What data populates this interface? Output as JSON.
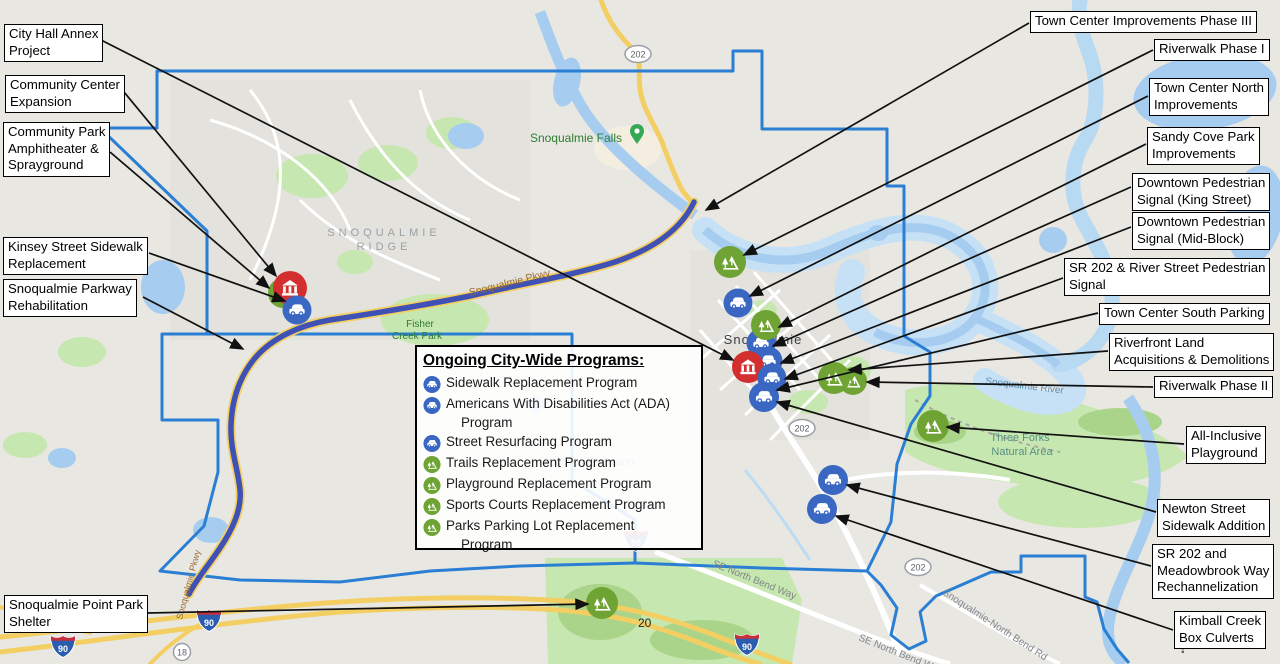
{
  "legend": {
    "title": "Ongoing City-Wide Programs:",
    "items": [
      {
        "icon": "car",
        "lines": [
          "Sidewalk Replacement Program"
        ]
      },
      {
        "icon": "car",
        "lines": [
          "Americans With Disabilities Act (ADA)",
          "Program"
        ]
      },
      {
        "icon": "car",
        "lines": [
          "Street Resurfacing Program"
        ]
      },
      {
        "icon": "park",
        "lines": [
          "Trails Replacement Program"
        ]
      },
      {
        "icon": "park",
        "lines": [
          "Playground Replacement Program"
        ]
      },
      {
        "icon": "park",
        "lines": [
          "Sports Courts Replacement Program"
        ]
      },
      {
        "icon": "park",
        "lines": [
          "Parks Parking Lot Replacement",
          "Program"
        ]
      }
    ]
  },
  "left_labels": [
    {
      "key": "city-hall-annex",
      "lines": [
        "City Hall Annex",
        "Project"
      ]
    },
    {
      "key": "community-center-expansion",
      "lines": [
        "Community Center",
        "Expansion"
      ]
    },
    {
      "key": "community-park-amphitheater",
      "lines": [
        "Community Park",
        "Amphitheater &",
        "Sprayground"
      ]
    },
    {
      "key": "kinsey-street-sidewalk",
      "lines": [
        "Kinsey Street Sidewalk",
        "Replacement"
      ]
    },
    {
      "key": "snoqualmie-parkway-rehab",
      "lines": [
        "Snoqualmie Parkway",
        "Rehabilitation"
      ]
    },
    {
      "key": "snoqualmie-point-park-shelter",
      "lines": [
        "Snoqualmie Point Park",
        "Shelter"
      ]
    }
  ],
  "right_labels": [
    {
      "key": "town-center-improvements-phase-3",
      "lines": [
        "Town Center Improvements Phase III"
      ]
    },
    {
      "key": "riverwalk-phase-1",
      "lines": [
        "Riverwalk Phase I"
      ]
    },
    {
      "key": "town-center-north-improvements",
      "lines": [
        "Town Center North",
        "Improvements"
      ]
    },
    {
      "key": "sandy-cove-park-improvements",
      "lines": [
        "Sandy Cove Park",
        "Improvements"
      ]
    },
    {
      "key": "downtown-pedestrian-signal-king-street",
      "lines": [
        "Downtown Pedestrian",
        "Signal (King Street)"
      ]
    },
    {
      "key": "downtown-pedestrian-signal-mid-block",
      "lines": [
        "Downtown Pedestrian",
        "Signal (Mid-Block)"
      ]
    },
    {
      "key": "sr202-river-street-pedestrian-signal",
      "lines": [
        "SR 202 & River Street Pedestrian",
        "Signal"
      ]
    },
    {
      "key": "town-center-south-parking",
      "lines": [
        "Town Center South Parking"
      ]
    },
    {
      "key": "riverfront-land-acquisitions",
      "lines": [
        "Riverfront Land",
        "Acquisitions & Demolitions"
      ]
    },
    {
      "key": "riverwalk-phase-2",
      "lines": [
        "Riverwalk Phase II"
      ]
    },
    {
      "key": "all-inclusive-playground",
      "lines": [
        "All-Inclusive",
        "Playground"
      ]
    },
    {
      "key": "newton-street-sidewalk-addition",
      "lines": [
        "Newton Street",
        "Sidewalk Addition"
      ]
    },
    {
      "key": "sr202-meadowbrook-way-rechannelization",
      "lines": [
        "SR 202 and",
        "Meadowbrook Way",
        "Rechannelization"
      ]
    },
    {
      "key": "kimball-creek-box-culverts",
      "lines": [
        "Kimball Creek",
        "Box Culverts"
      ]
    }
  ],
  "map_labels": {
    "city": "Snoqualmie",
    "ridge_line1": "SNOQUALMIE",
    "ridge_line2": "RIDGE",
    "falls": "Snoqualmie Falls",
    "fisher_line1": "Fisher",
    "fisher_line2": "Creek Park",
    "three_forks_line1": "Three Forks",
    "three_forks_line2": "Natural Area",
    "river": "Snoqualmie River",
    "casino": "Snoqualmie Casino",
    "parkway": "Snoqualmie Pkwy",
    "se_north_bend": "SE North Bend Way",
    "snoq_north_bend_rd": "Snoqualmie-North Bend Rd",
    "route_202": "202",
    "interstate_90": "90",
    "route_18": "18",
    "milepost_20": "20",
    "help": "?"
  },
  "colors": {
    "boundary": "#2a7fd4",
    "parkway_route": "#3f51b5",
    "highway_yellow": "#f3cf63",
    "water": "#a6cdf0",
    "water_light": "#c6e1f6",
    "park_green": "#c7e7b0",
    "marker_blue": "#3a67c2",
    "marker_green": "#6fa334",
    "marker_red": "#d32f2f",
    "callout_bg": "#ffffff",
    "connector": "#111111"
  }
}
